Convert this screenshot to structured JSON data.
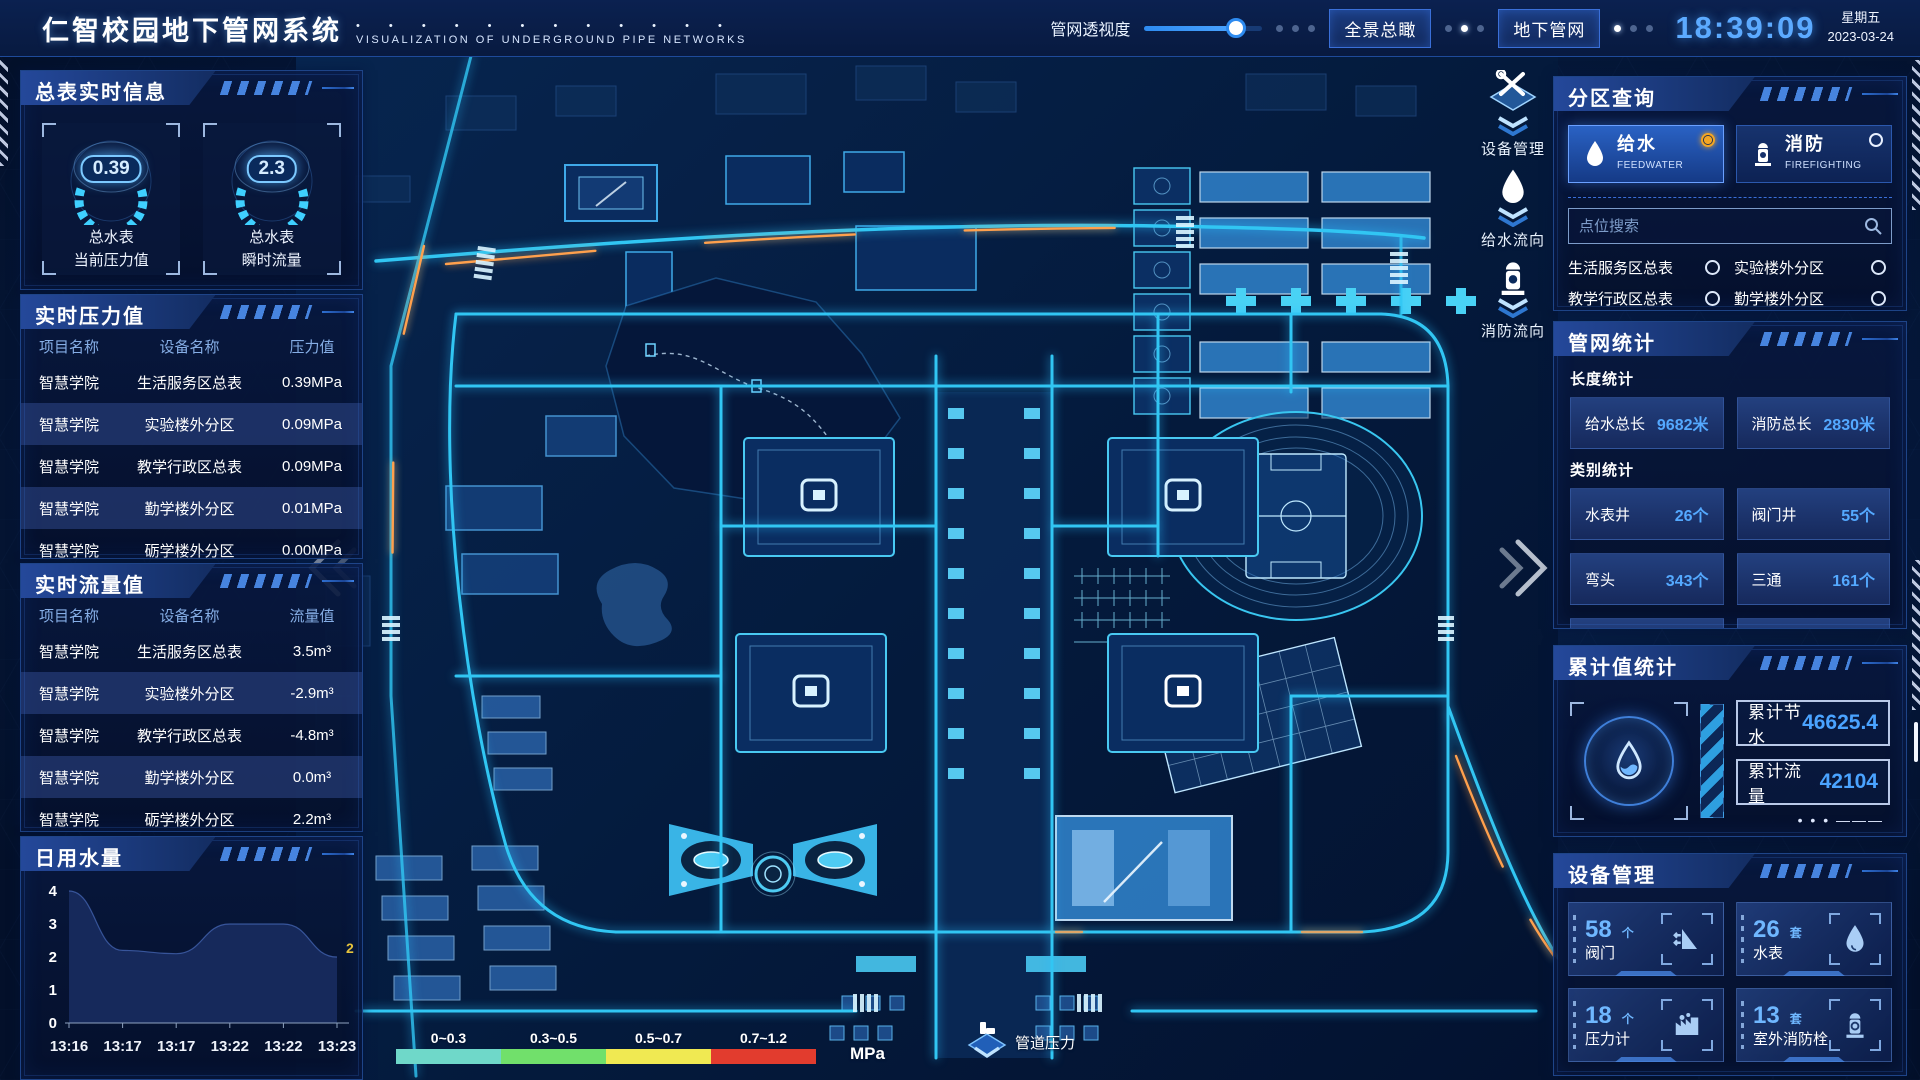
{
  "header": {
    "title": "仁智校园地下管网系统",
    "title_dots": "• • • • • • • • • • • •",
    "subtitle": "VISUALIZATION OF UNDERGROUND PIPE NETWORKS",
    "slider_label": "管网透视度",
    "slider_value": 78,
    "buttons": [
      {
        "label": "全景总瞰"
      },
      {
        "label": "地下管网"
      }
    ],
    "clock": {
      "time": "18:39:09",
      "weekday": "星期五",
      "date": "2023-03-24"
    }
  },
  "master_info": {
    "title": "总表实时信息",
    "gauges": [
      {
        "value": "0.39",
        "label_line1": "总水表",
        "label_line2": "当前压力值"
      },
      {
        "value": "2.3",
        "label_line1": "总水表",
        "label_line2": "瞬时流量"
      }
    ]
  },
  "pressure_panel": {
    "title": "实时压力值",
    "columns": [
      "项目名称",
      "设备名称",
      "压力值"
    ],
    "rows": [
      {
        "project": "智慧学院",
        "device": "生活服务区总表",
        "value": "0.39MPa"
      },
      {
        "project": "智慧学院",
        "device": "实验楼外分区",
        "value": "0.09MPa"
      },
      {
        "project": "智慧学院",
        "device": "教学行政区总表",
        "value": "0.09MPa"
      },
      {
        "project": "智慧学院",
        "device": "勤学楼外分区",
        "value": "0.01MPa"
      },
      {
        "project": "智慧学院",
        "device": "砺学楼外分区",
        "value": "0.00MPa"
      }
    ]
  },
  "flow_panel": {
    "title": "实时流量值",
    "columns": [
      "项目名称",
      "设备名称",
      "流量值"
    ],
    "rows": [
      {
        "project": "智慧学院",
        "device": "生活服务区总表",
        "value": "3.5m³"
      },
      {
        "project": "智慧学院",
        "device": "实验楼外分区",
        "value": "-2.9m³"
      },
      {
        "project": "智慧学院",
        "device": "教学行政区总表",
        "value": "-4.8m³"
      },
      {
        "project": "智慧学院",
        "device": "勤学楼外分区",
        "value": "0.0m³"
      },
      {
        "project": "智慧学院",
        "device": "砺学楼外分区",
        "value": "2.2m³"
      }
    ]
  },
  "daily_water": {
    "title": "日用水量"
  },
  "chart_data": {
    "type": "area",
    "title": "日用水量",
    "categories": [
      "13:16",
      "13:17",
      "13:17",
      "13:22",
      "13:22",
      "13:23"
    ],
    "values": [
      4,
      2.2,
      2.1,
      3,
      3,
      2
    ],
    "ylim": [
      0,
      4
    ],
    "yticks": [
      0,
      1,
      2,
      3,
      4
    ],
    "end_label": "2",
    "end_label_color": "#e6c33c",
    "area_fill": "#16295b"
  },
  "map": {
    "toolbar": [
      {
        "label": "设备管理",
        "icon": "tools-icon"
      },
      {
        "label": "给水流向",
        "icon": "water-drop-icon"
      },
      {
        "label": "消防流向",
        "icon": "hydrant-icon"
      }
    ],
    "legend": {
      "ranges": [
        {
          "label": "0~0.3",
          "color": "#6fd8c9"
        },
        {
          "label": "0.3~0.5",
          "color": "#71e06b"
        },
        {
          "label": "0.5~0.7",
          "color": "#f0e952"
        },
        {
          "label": "0.7~1.2",
          "color": "#e23c2e"
        }
      ],
      "unit": "MPa",
      "pressure_label": "管道压力"
    }
  },
  "zone_query": {
    "title": "分区查询",
    "tabs": [
      {
        "label": "给水",
        "sub": "FEEDWATER",
        "active": true
      },
      {
        "label": "消防",
        "sub": "FIREFIGHTING",
        "active": false
      }
    ],
    "search_placeholder": "点位搜索",
    "points": [
      "生活服务区总表",
      "实验楼外分区",
      "教学行政区总表",
      "勤学楼外分区",
      "砺学楼外分区",
      "宿舍区泵房"
    ]
  },
  "pipe_stats": {
    "title": "管网统计",
    "length_title": "长度统计",
    "length_stats": [
      {
        "label": "给水总长",
        "value": "9682米"
      },
      {
        "label": "消防总长",
        "value": "2830米"
      }
    ],
    "category_title": "类别统计",
    "category_stats": [
      {
        "label": "水表井",
        "value": "26个"
      },
      {
        "label": "阀门井",
        "value": "55个"
      },
      {
        "label": "弯头",
        "value": "343个"
      },
      {
        "label": "三通",
        "value": "161个"
      }
    ]
  },
  "cumulative": {
    "title": "累计值统计",
    "items": [
      {
        "label": "累计节水",
        "value": "46625.4"
      },
      {
        "label": "累计流量",
        "value": "42104"
      }
    ]
  },
  "devices": {
    "title": "设备管理",
    "cards": [
      {
        "count": "58",
        "unit": "个",
        "name": "阀门",
        "icon": "valve-icon"
      },
      {
        "count": "26",
        "unit": "套",
        "name": "水表",
        "icon": "water-meter-icon"
      },
      {
        "count": "18",
        "unit": "个",
        "name": "压力计",
        "icon": "pressure-gauge-icon"
      },
      {
        "count": "13",
        "unit": "套",
        "name": "室外消防栓",
        "icon": "outdoor-hydrant-icon"
      }
    ]
  }
}
